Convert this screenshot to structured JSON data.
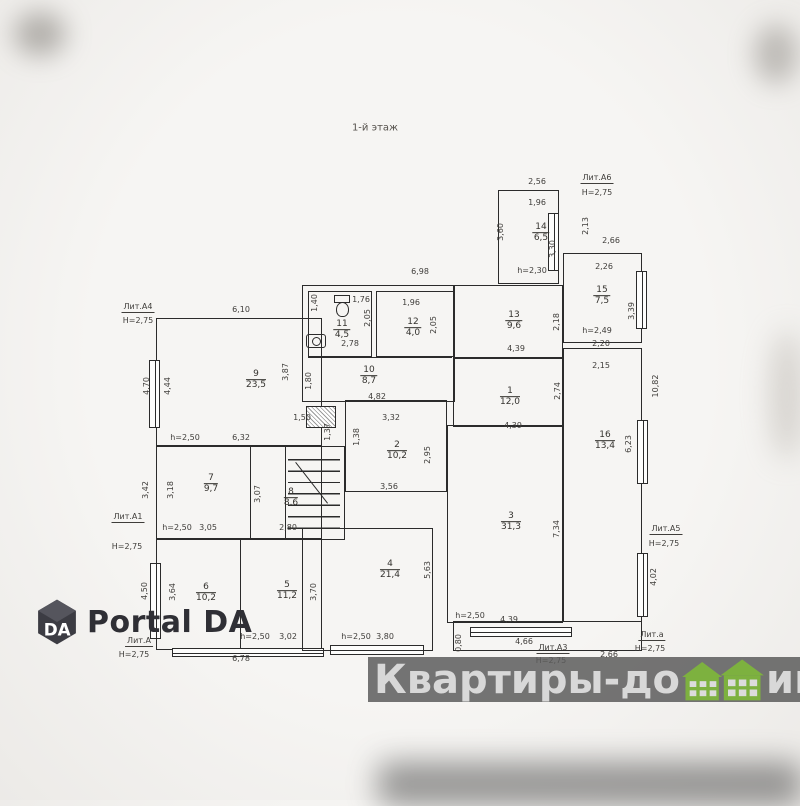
{
  "plan": {
    "title": "1-й этаж",
    "ink_color": "#2b2b2b",
    "rooms": [
      {
        "n": "9",
        "a": "23,5",
        "x": 256,
        "y": 380
      },
      {
        "n": "7",
        "a": "9,7",
        "x": 211,
        "y": 484
      },
      {
        "n": "8",
        "a": "8,6",
        "x": 291,
        "y": 498
      },
      {
        "n": "6",
        "a": "10,2",
        "x": 206,
        "y": 593
      },
      {
        "n": "5",
        "a": "11,2",
        "x": 287,
        "y": 591
      },
      {
        "n": "11",
        "a": "4,5",
        "x": 342,
        "y": 330
      },
      {
        "n": "12",
        "a": "4,0",
        "x": 413,
        "y": 328
      },
      {
        "n": "10",
        "a": "8,7",
        "x": 369,
        "y": 376
      },
      {
        "n": "2",
        "a": "10,2",
        "x": 397,
        "y": 451
      },
      {
        "n": "4",
        "a": "21,4",
        "x": 390,
        "y": 570
      },
      {
        "n": "13",
        "a": "9,6",
        "x": 514,
        "y": 321
      },
      {
        "n": "1",
        "a": "12,0",
        "x": 510,
        "y": 397
      },
      {
        "n": "3",
        "a": "31,3",
        "x": 511,
        "y": 522
      },
      {
        "n": "14",
        "a": "6,5",
        "x": 541,
        "y": 233
      },
      {
        "n": "15",
        "a": "7,5",
        "x": 602,
        "y": 296
      },
      {
        "n": "16",
        "a": "13,4",
        "x": 605,
        "y": 441
      }
    ],
    "dims": [
      {
        "t": "2,56",
        "x": 537,
        "y": 182
      },
      {
        "t": "Лит.А6",
        "x": 597,
        "y": 179,
        "u": 1
      },
      {
        "t": "H=2,75",
        "x": 597,
        "y": 193
      },
      {
        "t": "1,96",
        "x": 537,
        "y": 203
      },
      {
        "t": "3,60",
        "x": 501,
        "y": 232,
        "r": 1
      },
      {
        "t": "2,13",
        "x": 586,
        "y": 226,
        "r": 1
      },
      {
        "t": "3,30",
        "x": 553,
        "y": 249,
        "r": 1
      },
      {
        "t": "h=2,30",
        "x": 532,
        "y": 271
      },
      {
        "t": "2,66",
        "x": 611,
        "y": 241
      },
      {
        "t": "2,26",
        "x": 604,
        "y": 267
      },
      {
        "t": "3,39",
        "x": 632,
        "y": 311,
        "r": 1
      },
      {
        "t": "h=2,49",
        "x": 597,
        "y": 331
      },
      {
        "t": "2,20",
        "x": 601,
        "y": 344
      },
      {
        "t": "2,15",
        "x": 601,
        "y": 366
      },
      {
        "t": "10,82",
        "x": 656,
        "y": 386,
        "r": 1
      },
      {
        "t": "6,23",
        "x": 629,
        "y": 444,
        "r": 1
      },
      {
        "t": "Лит.А5",
        "x": 666,
        "y": 530,
        "u": 1
      },
      {
        "t": "H=2,75",
        "x": 664,
        "y": 544
      },
      {
        "t": "4,02",
        "x": 654,
        "y": 577,
        "r": 1
      },
      {
        "t": "Лит.а",
        "x": 652,
        "y": 636,
        "u": 1
      },
      {
        "t": "H=2,75",
        "x": 650,
        "y": 649
      },
      {
        "t": "Лит.А4",
        "x": 138,
        "y": 308,
        "u": 1
      },
      {
        "t": "H=2,75",
        "x": 138,
        "y": 321
      },
      {
        "t": "6,10",
        "x": 241,
        "y": 310
      },
      {
        "t": "4,70",
        "x": 147,
        "y": 386,
        "r": 1
      },
      {
        "t": "4,44",
        "x": 168,
        "y": 386,
        "r": 1
      },
      {
        "t": "3,87",
        "x": 286,
        "y": 372,
        "r": 1
      },
      {
        "t": "h=2,50",
        "x": 185,
        "y": 438
      },
      {
        "t": "6,32",
        "x": 241,
        "y": 438
      },
      {
        "t": "3,42",
        "x": 146,
        "y": 490,
        "r": 1
      },
      {
        "t": "3,18",
        "x": 171,
        "y": 490,
        "r": 1
      },
      {
        "t": "3,07",
        "x": 258,
        "y": 494,
        "r": 1
      },
      {
        "t": "h=2,50",
        "x": 177,
        "y": 528
      },
      {
        "t": "3,05",
        "x": 208,
        "y": 528
      },
      {
        "t": "2,80",
        "x": 288,
        "y": 528
      },
      {
        "t": "Лит.А1",
        "x": 128,
        "y": 518,
        "u": 1
      },
      {
        "t": "H=2,75",
        "x": 127,
        "y": 547
      },
      {
        "t": "4,50",
        "x": 145,
        "y": 591,
        "r": 1
      },
      {
        "t": "3,64",
        "x": 173,
        "y": 592,
        "r": 1
      },
      {
        "t": "3,70",
        "x": 314,
        "y": 592,
        "r": 1
      },
      {
        "t": "h=2,50",
        "x": 255,
        "y": 637
      },
      {
        "t": "3,02",
        "x": 288,
        "y": 637
      },
      {
        "t": "6,78",
        "x": 241,
        "y": 659
      },
      {
        "t": "Лит.А",
        "x": 139,
        "y": 642,
        "u": 1
      },
      {
        "t": "H=2,75",
        "x": 134,
        "y": 655
      },
      {
        "t": "6,98",
        "x": 420,
        "y": 272
      },
      {
        "t": "1,40",
        "x": 315,
        "y": 303,
        "r": 1
      },
      {
        "t": "1,76",
        "x": 361,
        "y": 300
      },
      {
        "t": "1,96",
        "x": 411,
        "y": 303
      },
      {
        "t": "2,05",
        "x": 368,
        "y": 318,
        "r": 1
      },
      {
        "t": "2,05",
        "x": 434,
        "y": 325,
        "r": 1
      },
      {
        "t": "2,78",
        "x": 350,
        "y": 344
      },
      {
        "t": "1,80",
        "x": 309,
        "y": 381,
        "r": 1
      },
      {
        "t": "4,82",
        "x": 377,
        "y": 397
      },
      {
        "t": "1,50",
        "x": 302,
        "y": 418
      },
      {
        "t": "1,37",
        "x": 328,
        "y": 432,
        "r": 1
      },
      {
        "t": "3,32",
        "x": 391,
        "y": 418
      },
      {
        "t": "1,38",
        "x": 357,
        "y": 437,
        "r": 1
      },
      {
        "t": "2,95",
        "x": 428,
        "y": 455,
        "r": 1
      },
      {
        "t": "3,56",
        "x": 389,
        "y": 487
      },
      {
        "t": "2,18",
        "x": 557,
        "y": 322,
        "r": 1
      },
      {
        "t": "4,39",
        "x": 516,
        "y": 349
      },
      {
        "t": "2,74",
        "x": 558,
        "y": 391,
        "r": 1
      },
      {
        "t": "4,39",
        "x": 513,
        "y": 426
      },
      {
        "t": "7,34",
        "x": 557,
        "y": 529,
        "r": 1
      },
      {
        "t": "5,63",
        "x": 428,
        "y": 570,
        "r": 1
      },
      {
        "t": "h=2,50",
        "x": 356,
        "y": 637
      },
      {
        "t": "3,80",
        "x": 385,
        "y": 637
      },
      {
        "t": "0,80",
        "x": 459,
        "y": 643,
        "r": 1
      },
      {
        "t": "h=2,50",
        "x": 470,
        "y": 616
      },
      {
        "t": "4,39",
        "x": 509,
        "y": 620
      },
      {
        "t": "4,66",
        "x": 524,
        "y": 642
      },
      {
        "t": "Лит.А3",
        "x": 553,
        "y": 649,
        "u": 1
      },
      {
        "t": "H=2,75",
        "x": 551,
        "y": 661
      },
      {
        "t": "2,66",
        "x": 609,
        "y": 655
      }
    ]
  },
  "watermark": {
    "full_text": "Квартиры-домики.рф",
    "part1": "Квартиры-до",
    "part2": "ики.рф",
    "house_color": "#7db13f",
    "band_color": "#5c5c5c"
  },
  "logo": {
    "text": "Portal DA",
    "mark": "DA",
    "mark_color": "#3c3c43"
  }
}
